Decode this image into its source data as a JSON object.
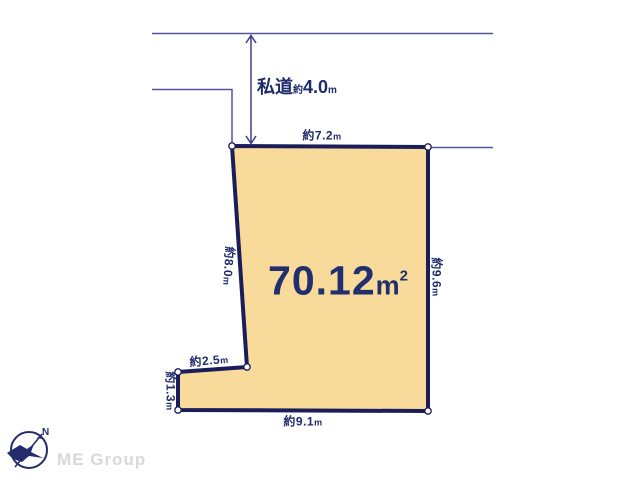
{
  "road": {
    "name": "私道",
    "approx": "約",
    "value": "4.0",
    "unit": "m"
  },
  "dims": {
    "top": {
      "v": "約7.2",
      "u": "m"
    },
    "right": {
      "v": "約9.6",
      "u": "m"
    },
    "left": {
      "v": "約8.0",
      "u": "m"
    },
    "bottom": {
      "v": "約9.1",
      "u": "m"
    },
    "step": {
      "v": "約2.5",
      "u": "m"
    },
    "step_side": {
      "v": "約1.3",
      "u": "m"
    }
  },
  "area": {
    "value": "70.12",
    "unit": "m",
    "superscript": "2"
  },
  "compass": {
    "north": "N"
  },
  "brand": {
    "name": "ME Group"
  },
  "colors": {
    "parcel_fill": "#f8db9a",
    "parcel_border": "#1b1c5a",
    "label_navy": "#1d2a6b",
    "thin_line": "#55559f",
    "brand_gray": "#d9d9d9",
    "background": "#ffffff"
  }
}
